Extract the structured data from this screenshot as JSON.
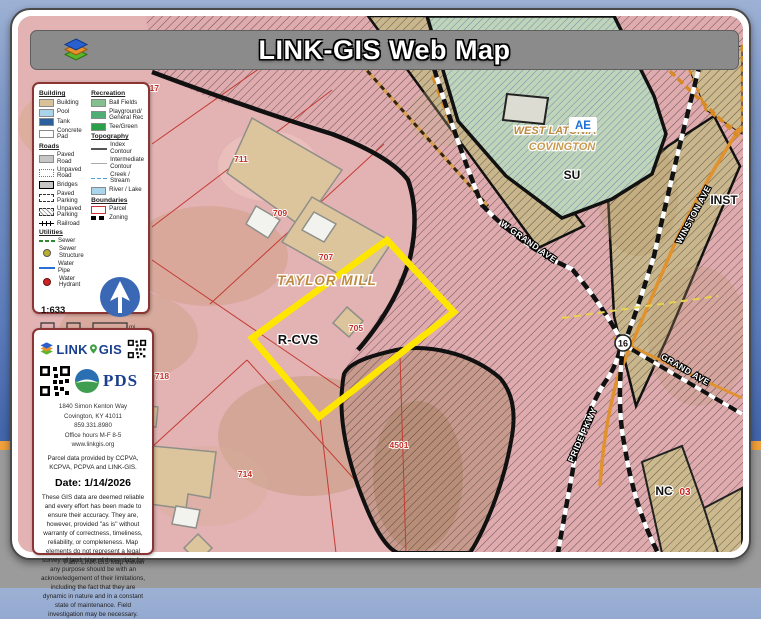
{
  "window": {
    "title": "LINK-GIS Web Map",
    "path_bar": "Path: LINK-GIS Map Viewer"
  },
  "legend": {
    "building": {
      "header": "Building",
      "items": [
        "Building",
        "Pool",
        "Tank",
        "Concrete Pad"
      ]
    },
    "roads": {
      "header": "Roads",
      "items": [
        "Paved Road",
        "Unpaved Road",
        "Bridges",
        "Paved Parking",
        "Unpaved Parking",
        "Railroad"
      ]
    },
    "utilities": {
      "header": "Utilities",
      "items": [
        "Sewer",
        "Sewer Structure",
        "Water Pipe",
        "Water Hydrant"
      ]
    },
    "recreation": {
      "header": "Recreation",
      "items": [
        "Ball Fields",
        "Playground/ General Rec",
        "Tee/Green"
      ]
    },
    "topography": {
      "header": "Topography",
      "items": [
        "Index Contour",
        "Intermediate Contour",
        "Creek / Stream",
        "River / Lake"
      ]
    },
    "boundaries": {
      "header": "Boundaries",
      "items": [
        "Parcel",
        "Zoning"
      ]
    }
  },
  "scale": {
    "ratio": "1:633",
    "ticks": [
      "0",
      "0",
      "0.01",
      "0.01"
    ],
    "unit": "mi"
  },
  "info": {
    "logo_link": "LINK",
    "logo_gis": "GIS",
    "pds_label": "PDS",
    "address_lines": [
      "1840 Simon Kenton Way",
      "Covington, KY 41011",
      "859.331.8980",
      "Office hours M-F 8-5",
      "www.linkgis.org"
    ],
    "parcel_note": "Parcel data provided by CCPVA, KCPVA, PCPVA and LINK-GIS.",
    "date": "Date: 1/14/2026",
    "disclaimer": "These GIS data are deemed reliable and every effort has been made to ensure their accuracy. They are, however, provided \"as is\" without warranty of correctness, timeliness, reliability, or completeness.  Map elements do not represent a legal survey of land. Use of these data for any purpose should be with an acknowledgement of their limitations, including the fact that they are dynamic in nature and in a constant state of maintenance. Field investigation may be necessary."
  },
  "map": {
    "cities": {
      "taylor_mill": "TAYLOR MILL",
      "west_latonia": "WEST LATONIA",
      "covington": "COVINGTON"
    },
    "zones": {
      "ae": "AE",
      "su": "SU",
      "inst": "INST",
      "rcvs": "R-CVS",
      "nc": "NC"
    },
    "streets": {
      "w_grand": "W GRAND AVE",
      "winston": "WINSTON AVE",
      "grand": "GRAND AVE",
      "pride": "PRIDE PKWY"
    },
    "route_shield": "16",
    "parcels": {
      "p717": "717",
      "p711": "711",
      "p709": "709",
      "p707": "707",
      "p705": "705",
      "p718": "718",
      "p714": "714",
      "p4501": "4501",
      "p03": "03"
    },
    "colors": {
      "highlight": "#ffe600",
      "parcel_line": "#c33b33",
      "city_label": "#bd8a3e",
      "zone_label": "#111111",
      "road_orange": "#e0922e"
    }
  }
}
